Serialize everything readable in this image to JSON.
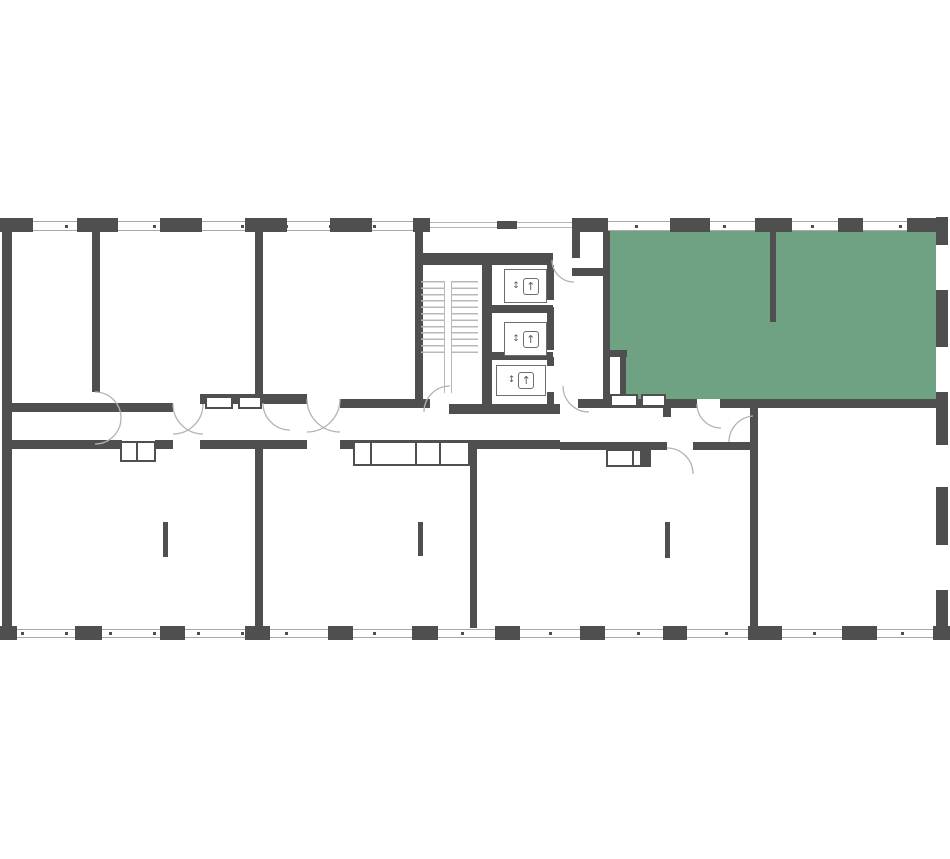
{
  "plan": {
    "kind": "apartment-floor-plan",
    "highlighted_unit": {
      "status": "selected",
      "fill": "#6fa183"
    }
  },
  "colors": {
    "wall": "#4f4f4f",
    "highlight_green": "#6fa183",
    "light_line": "#b5b5b5",
    "background": "#ffffff"
  },
  "icons": {
    "elevator_up": "↑",
    "elevator_updown": "↕"
  },
  "elevators": [
    {
      "updown": "↕",
      "up": "↑"
    },
    {
      "updown": "↕",
      "up": "↑"
    },
    {
      "updown": "↕",
      "up": "↑"
    }
  ]
}
